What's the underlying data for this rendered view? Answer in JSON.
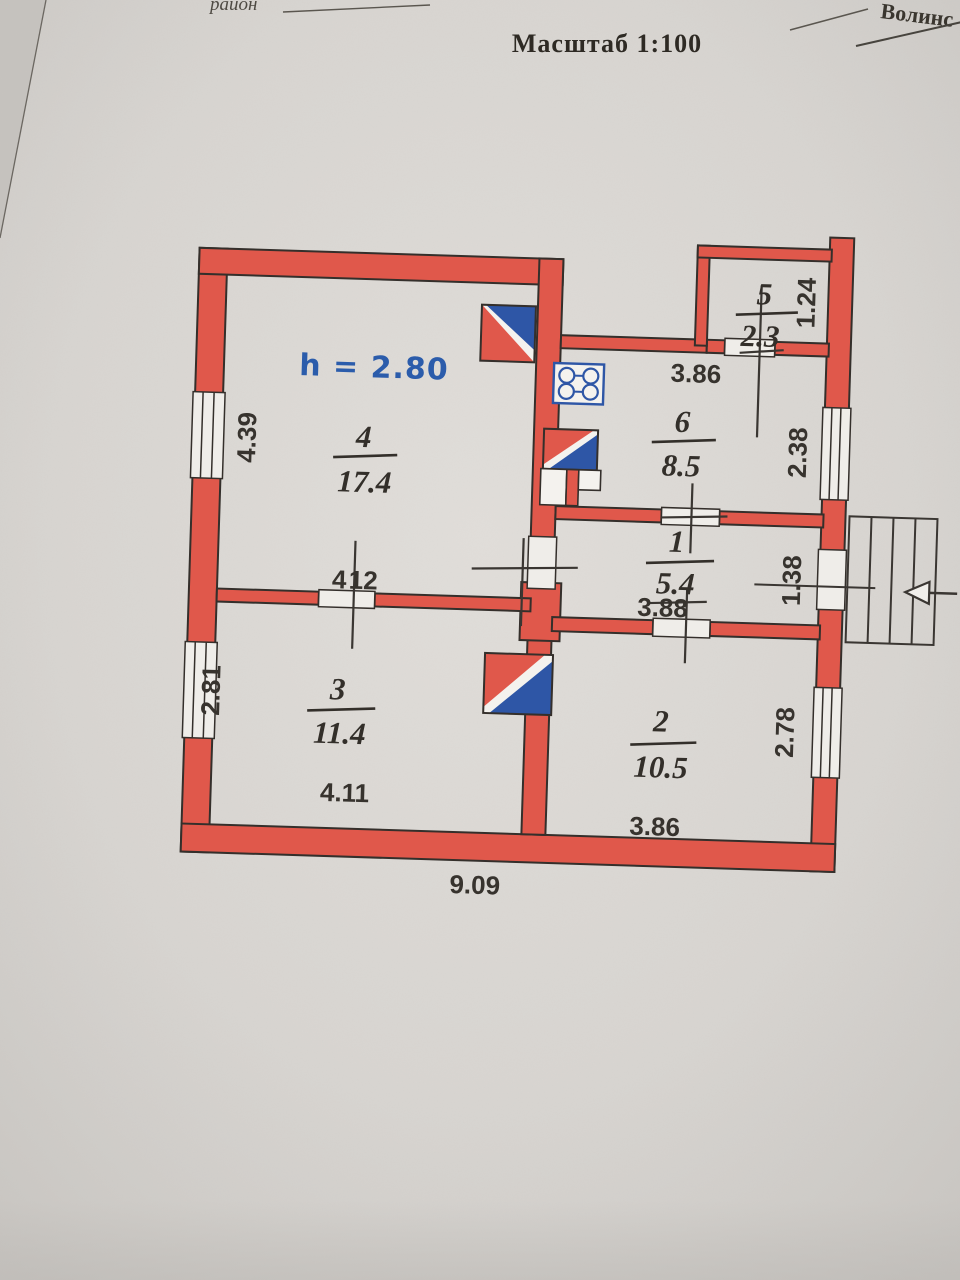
{
  "header": {
    "script_left": "район",
    "script_right": "Волинс",
    "title": "Масштаб 1:100"
  },
  "plan": {
    "height_note": "h = 2.80",
    "rooms": {
      "r1": {
        "num": "1",
        "area": "5.4"
      },
      "r2": {
        "num": "2",
        "area": "10.5"
      },
      "r3": {
        "num": "3",
        "area": "11.4"
      },
      "r4": {
        "num": "4",
        "area": "17.4"
      },
      "r5": {
        "num": "5",
        "area": "2.3"
      },
      "r6": {
        "num": "6",
        "area": "8.5"
      }
    },
    "dims": {
      "left_window_top": "4.39",
      "left_window_bottom": "2.81",
      "kitchen_top": "3.86",
      "hall": "3.88",
      "room2_bottom": "3.86",
      "room3_bottom": "4.11",
      "overall_bottom": "9.09",
      "right_window_top": "2.38",
      "entrance_door": "1.38",
      "right_window_bottom": "2.78",
      "porch_side": "1.24",
      "room3_top_left": "4",
      "room3_top_right": "12"
    },
    "symbols": {
      "stove": "gas-stove-icon",
      "flue": "chimney-flue-icon",
      "stairs": "entrance-steps",
      "arrow": "entrance-direction-arrow"
    }
  },
  "colors": {
    "wall": "#e0584b",
    "blue": "#2e56a6",
    "ink": "#37332e",
    "blue_text": "#2b5cab",
    "paper": "#d8d5d1"
  }
}
